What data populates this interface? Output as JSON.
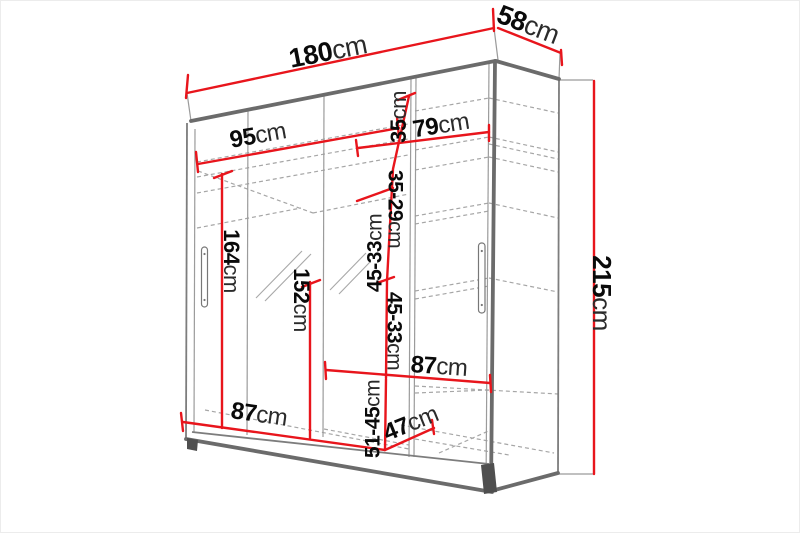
{
  "meta": {
    "title": "Sliding wardrobe dimension diagram",
    "unit": "cm"
  },
  "colors": {
    "dimension_accent": "#e8151c",
    "structure_line": "#6b6b6b",
    "hidden_line": "#a6a6a6"
  },
  "dimensions": {
    "total_width": {
      "value": "180",
      "unit": "cm"
    },
    "total_depth": {
      "value": "58",
      "unit": "cm"
    },
    "total_height": {
      "value": "215",
      "unit": "cm"
    },
    "left_interior_width": {
      "value": "95",
      "unit": "cm"
    },
    "right_interior_width": {
      "value": "79",
      "unit": "cm"
    },
    "left_hanging_height": {
      "value": "164",
      "unit": "cm"
    },
    "center_hanging_height": {
      "value": "152",
      "unit": "cm"
    },
    "top_shelf_height": {
      "value": "35",
      "unit": "cm"
    },
    "upper_shelf_height": {
      "value": "35-29",
      "unit": "cm"
    },
    "shelf_gap_upper": {
      "value": "45-33",
      "unit": "cm"
    },
    "shelf_gap_lower": {
      "value": "45-33",
      "unit": "cm"
    },
    "bottom_left_width": {
      "value": "87",
      "unit": "cm"
    },
    "right_shelf_width": {
      "value": "87",
      "unit": "cm"
    },
    "bottom_shelf_depth": {
      "value": "47",
      "unit": "cm"
    },
    "bottom_shelf_height": {
      "value": "51-45",
      "unit": "cm"
    }
  }
}
